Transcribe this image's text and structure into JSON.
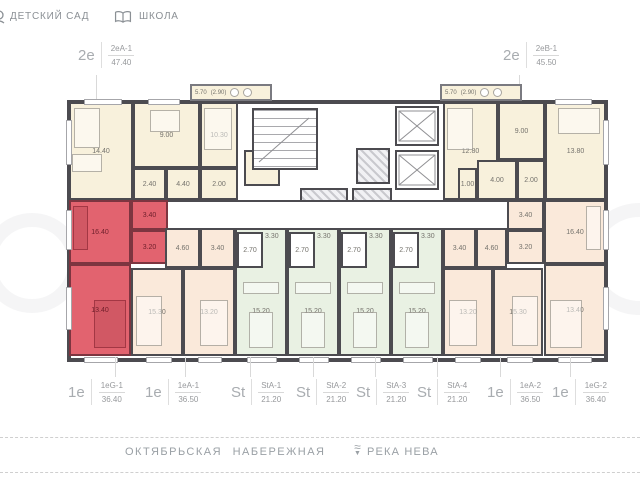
{
  "legend": {
    "kindergarten": "ДЕТСКИЙ САД",
    "school": "ШКОЛА"
  },
  "callouts": {
    "top": [
      {
        "type": "2е",
        "code": "2еА-1",
        "area": "47.40"
      },
      {
        "type": "2е",
        "code": "2еВ-1",
        "area": "45.50"
      }
    ],
    "bottom": [
      {
        "type": "1е",
        "code": "1еG-1",
        "area": "36.40"
      },
      {
        "type": "1е",
        "code": "1еА-1",
        "area": "36.50"
      },
      {
        "type": "St",
        "code": "StА-1",
        "area": "21.20"
      },
      {
        "type": "St",
        "code": "StА-2",
        "area": "21.20"
      },
      {
        "type": "St",
        "code": "StА-3",
        "area": "21.20"
      },
      {
        "type": "St",
        "code": "StА-4",
        "area": "21.20"
      },
      {
        "type": "1е",
        "code": "1еА-2",
        "area": "36.50"
      },
      {
        "type": "1е",
        "code": "1еG-2",
        "area": "36.40"
      }
    ]
  },
  "plan": {
    "balcony_left": {
      "area": "5.70",
      "half": "(2.90)"
    },
    "balcony_right": {
      "area": "5.70",
      "half": "(2.90)"
    },
    "apt_2eA1": {
      "r14": "14.40",
      "r9": "9.00",
      "r10": "10.30",
      "r24": "2.40",
      "r44": "4.40",
      "wc1": "2.00",
      "wc2": "2.00"
    },
    "apt_2eB1": {
      "r128": "12.80",
      "r9": "9.00",
      "r138": "13.80",
      "r4": "4.00",
      "r1": "1.00",
      "wc": "2.00"
    },
    "apt_1eG1": {
      "r164": "16.40",
      "hall": "3.40",
      "wc": "3.20",
      "r134": "13.40"
    },
    "apt_1eA1": {
      "hall": "4.60",
      "wc": "3.40",
      "r153": "15.30",
      "r132": "13.20"
    },
    "studios": [
      {
        "entry": "3.30",
        "wc": "2.70",
        "room": "15.20"
      },
      {
        "entry": "3.30",
        "wc": "2.70",
        "room": "15.20"
      },
      {
        "entry": "3.30",
        "wc": "2.70",
        "room": "15.20"
      },
      {
        "entry": "3.30",
        "wc": "2.70",
        "room": "15.20"
      }
    ],
    "apt_1eA2": {
      "wc": "3.40",
      "hall": "4.60",
      "r132": "13.20",
      "r153": "15.30"
    },
    "apt_1eG2": {
      "hall": "3.40",
      "wc": "3.20",
      "r164": "16.40",
      "r134": "13.40"
    }
  },
  "footer": {
    "street": "ОКТЯБРЬСКАЯ  НАБЕРЕЖНАЯ",
    "river": "РЕКА НЕВА"
  },
  "colors": {
    "highlight": "#e2636f",
    "cream": "#f8f1dc",
    "green": "#e9f1e3",
    "peach": "#fae9da",
    "wall": "#4c4b50"
  }
}
